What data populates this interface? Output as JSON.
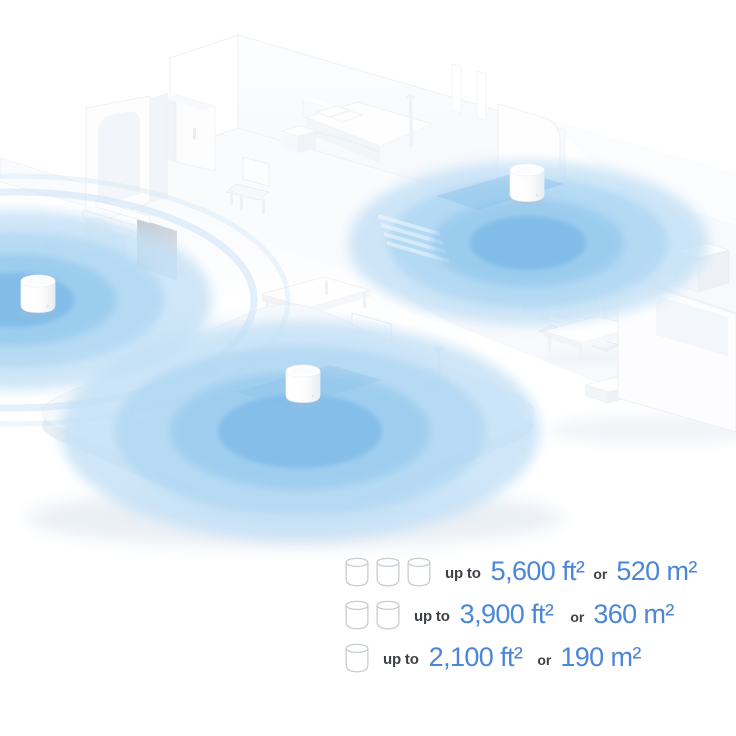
{
  "legend": {
    "rows": [
      {
        "units": 3,
        "up_to": "up to",
        "imperial": "5,600 ft²",
        "or": "or",
        "metric": "520 m²"
      },
      {
        "units": 2,
        "up_to": "up to",
        "imperial": "3,900 ft²",
        "or": "or",
        "metric": "360 m²"
      },
      {
        "units": 1,
        "up_to": "up to",
        "imperial": "2,100 ft²",
        "or": "or",
        "metric": "190 m²"
      }
    ]
  },
  "scene": {
    "description": "Isometric two-level home cutaway with three mesh Wi-Fi units and blue coverage circles",
    "units": [
      {
        "id": "unit-top-right"
      },
      {
        "id": "unit-left"
      },
      {
        "id": "unit-bottom-center"
      }
    ]
  },
  "colors": {
    "value_blue": "#4a87d8",
    "label_dark": "#3e4247",
    "icon_outline": "#c6cbd2",
    "coverage_outer": "#c2e0f6",
    "coverage_mid": "#a8d4f2",
    "coverage_inner": "#8cc4ec",
    "coverage_core": "#74b5e6",
    "coverage_ripple": "#c8e2f7",
    "page_background": "#ffffff"
  }
}
